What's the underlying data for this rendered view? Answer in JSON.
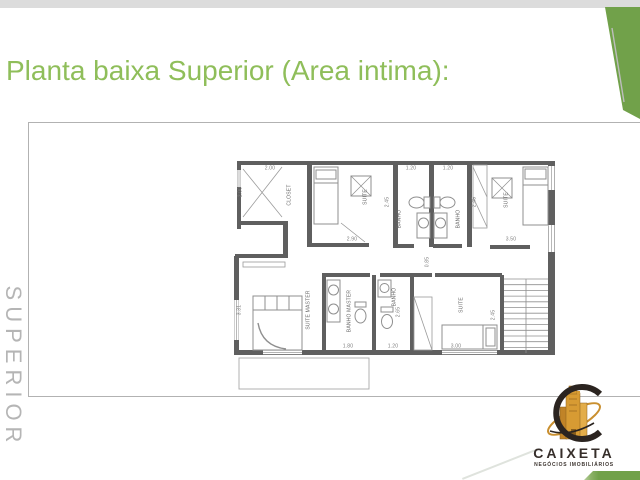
{
  "slide": {
    "title": "Planta baixa Superior (Area intima):",
    "side_label": "SUPERIOR"
  },
  "plan": {
    "rooms": [
      "CLOSET",
      "SUITE",
      "BANHO",
      "BANHO",
      "SUITE",
      "SUITE MASTER",
      "BANHO MASTER",
      "BANHO",
      "SUITE"
    ],
    "dims_h": [
      "2.00",
      "1.20",
      "1.20",
      "2.90",
      "3.50",
      "1.80",
      "1.20",
      "3.00"
    ],
    "dims_v": [
      "2.00",
      "2.45",
      "2.45",
      "0.85",
      "3.31",
      "2.65",
      "2.45"
    ]
  },
  "logo": {
    "name": "CAIXETA",
    "tagline": "NEGÓCIOS IMOBILIÁRIOS"
  },
  "colors": {
    "title_green": "#8FBE5A",
    "accent_green": "#71A14A",
    "wall_gray": "#5F5F5F"
  }
}
